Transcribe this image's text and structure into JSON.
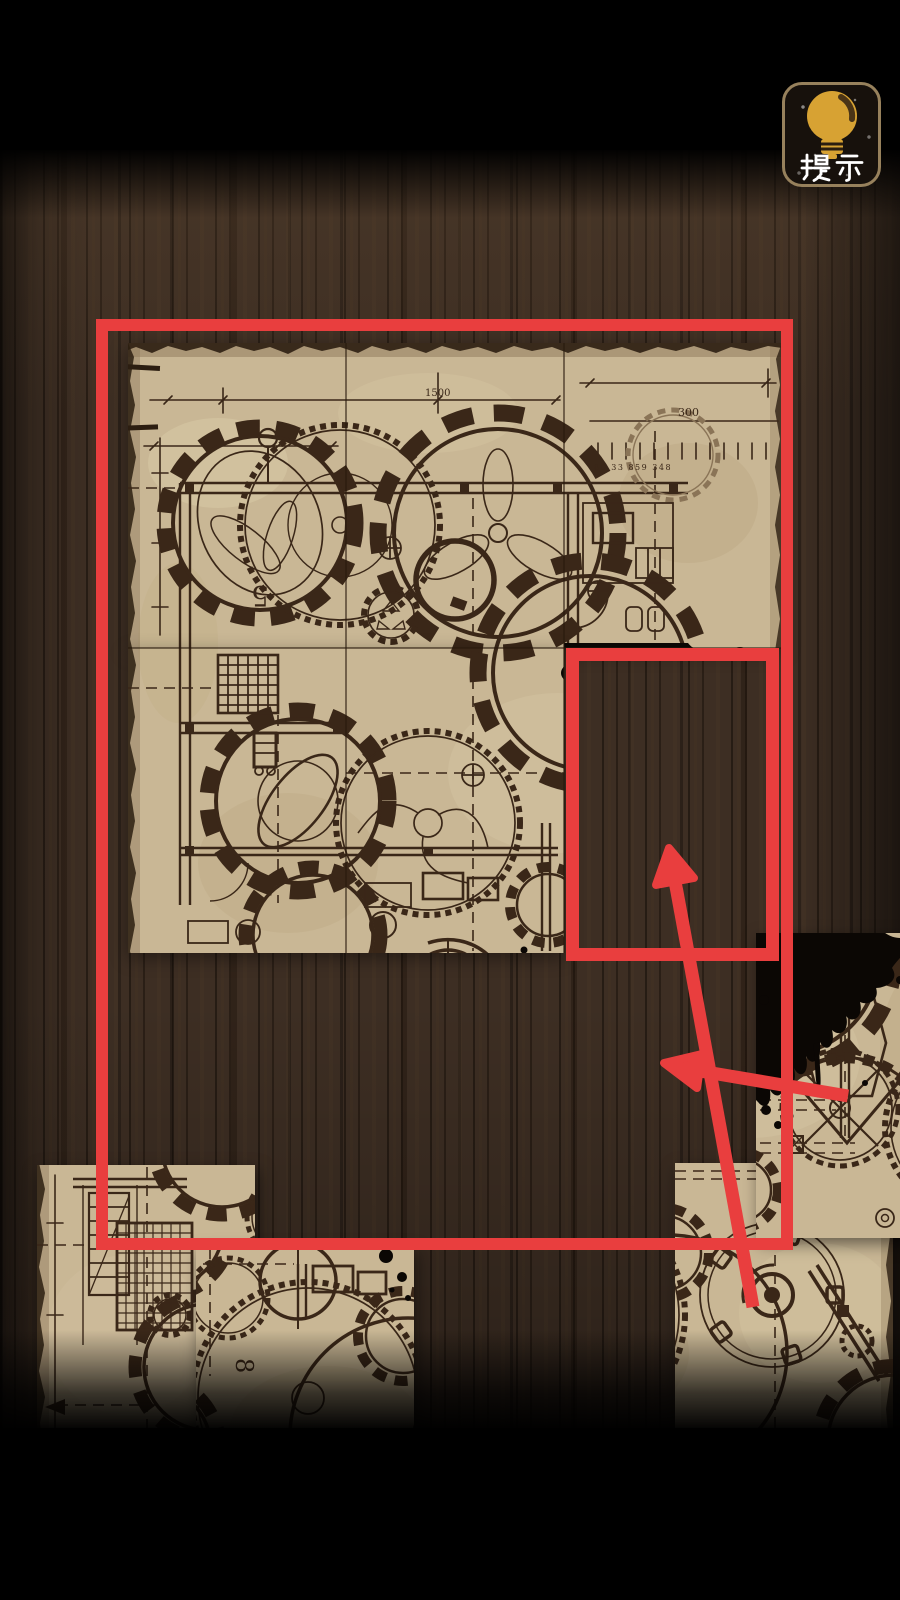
{
  "hint_button": {
    "label": "提示"
  },
  "blueprint": {
    "labels": {
      "n1500": "1500",
      "n300": "300",
      "ticks": "80 33 859 348",
      "n340": "340",
      "n5": "5",
      "n8": "8"
    }
  },
  "colors": {
    "annotation_red": "#e93e3e",
    "parchment": "#c9b795",
    "ink": "#3a2718",
    "wood": "#3d2e23",
    "gold": "#d7a233",
    "button_border": "#97815c"
  }
}
